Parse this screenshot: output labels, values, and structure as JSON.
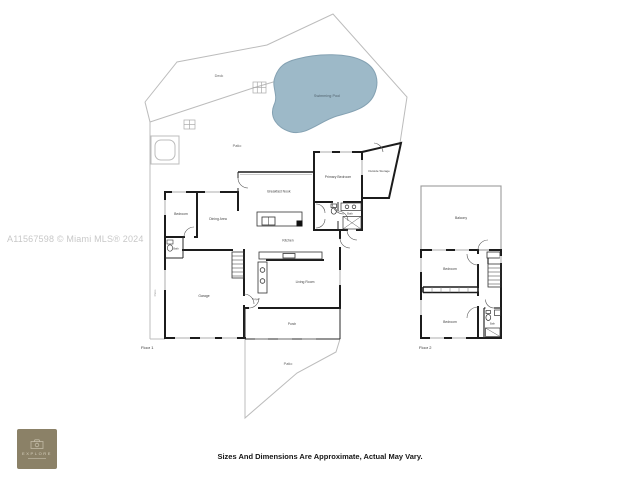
{
  "watermark": "A11567598 © Miami MLS® 2024",
  "disclaimer": "Sizes And Dimensions Are Approximate, Actual May Vary.",
  "logo": {
    "brand": "EXPLORE"
  },
  "site": {
    "deck_label": "Deck",
    "upper_patio_label": "Patio",
    "lower_patio_label": "Patio",
    "left_patio_label": "Patio",
    "pool_label": "Swimming Pool"
  },
  "floor1": {
    "name": "Floor 1",
    "rooms": {
      "bedroom": "Bedroom",
      "bath_left": "Bath",
      "dining": "Dining Area",
      "breakfast_nook": "Breakfast Nook",
      "kitchen": "Kitchen",
      "primary_bedroom": "Primary Bedroom",
      "outside_storage": "Outside Storage",
      "bath": "Bath",
      "garage": "Garage",
      "living_room": "Living Room",
      "foyer": "Foyer",
      "porch": "Porch"
    }
  },
  "floor2": {
    "name": "Floor 2",
    "rooms": {
      "balcony": "Balcony",
      "bedroom_1": "Bedroom",
      "bedroom_2": "Bedroom",
      "bath": "Bath"
    }
  },
  "colors": {
    "pool_fill": "#9db9c8",
    "pool_stroke": "#84a1b2",
    "wall": "#1c1c1c",
    "site_line": "#bcbcbc",
    "watermark": "#c8c8c8",
    "logo_bg": "#8b8167"
  }
}
